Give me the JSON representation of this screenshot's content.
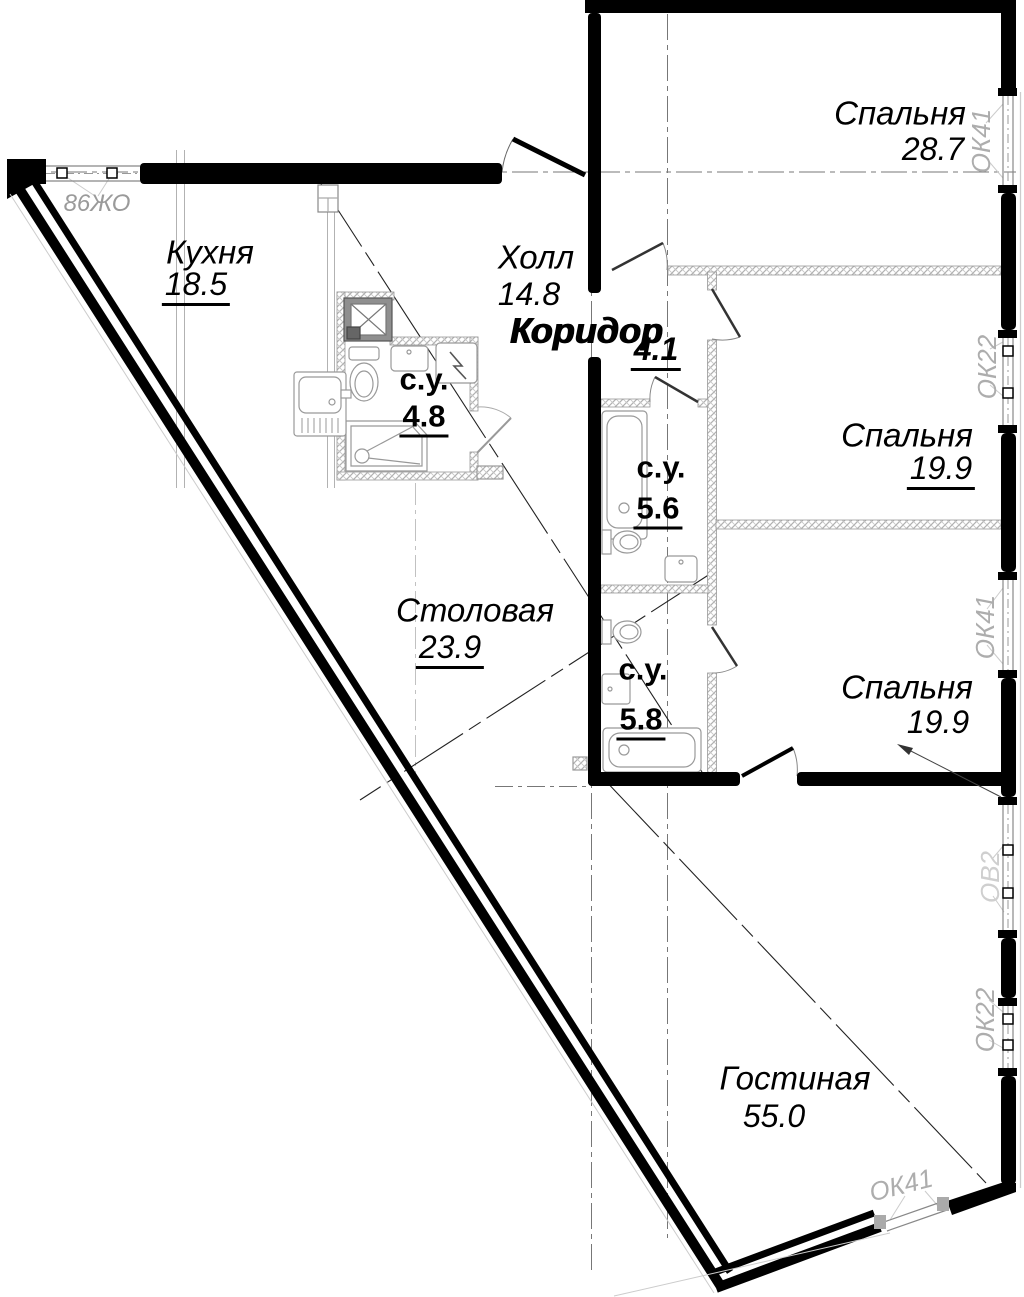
{
  "plan": {
    "background": "#ffffff",
    "wall_color": "#000000",
    "partition_hatch_color": "#b0b0b0",
    "window_label_color": "#adadad",
    "rooms": [
      {
        "name": "Спальня",
        "area": "28.7"
      },
      {
        "name": "Кухня",
        "area": "18.5"
      },
      {
        "name": "Холл",
        "area": "14.8"
      },
      {
        "name": "Коридор",
        "area": "4.1"
      },
      {
        "name": "с.у.",
        "area": "4.8"
      },
      {
        "name": "с.у.",
        "area": "5.6"
      },
      {
        "name": "Спальня",
        "area": "19.9"
      },
      {
        "name": "Столовая",
        "area": "23.9"
      },
      {
        "name": "с.у.",
        "area": "5.8"
      },
      {
        "name": "Спальня",
        "area": "19.9"
      },
      {
        "name": "Гостиная",
        "area": "55.0"
      }
    ],
    "window_labels": {
      "top_left": "86ЖО",
      "right_1": "ОК41",
      "right_2": "ОК22",
      "right_3": "ОК41",
      "right_4": "ОВ2",
      "right_5": "ОК22",
      "bottom": "ОК41"
    }
  }
}
